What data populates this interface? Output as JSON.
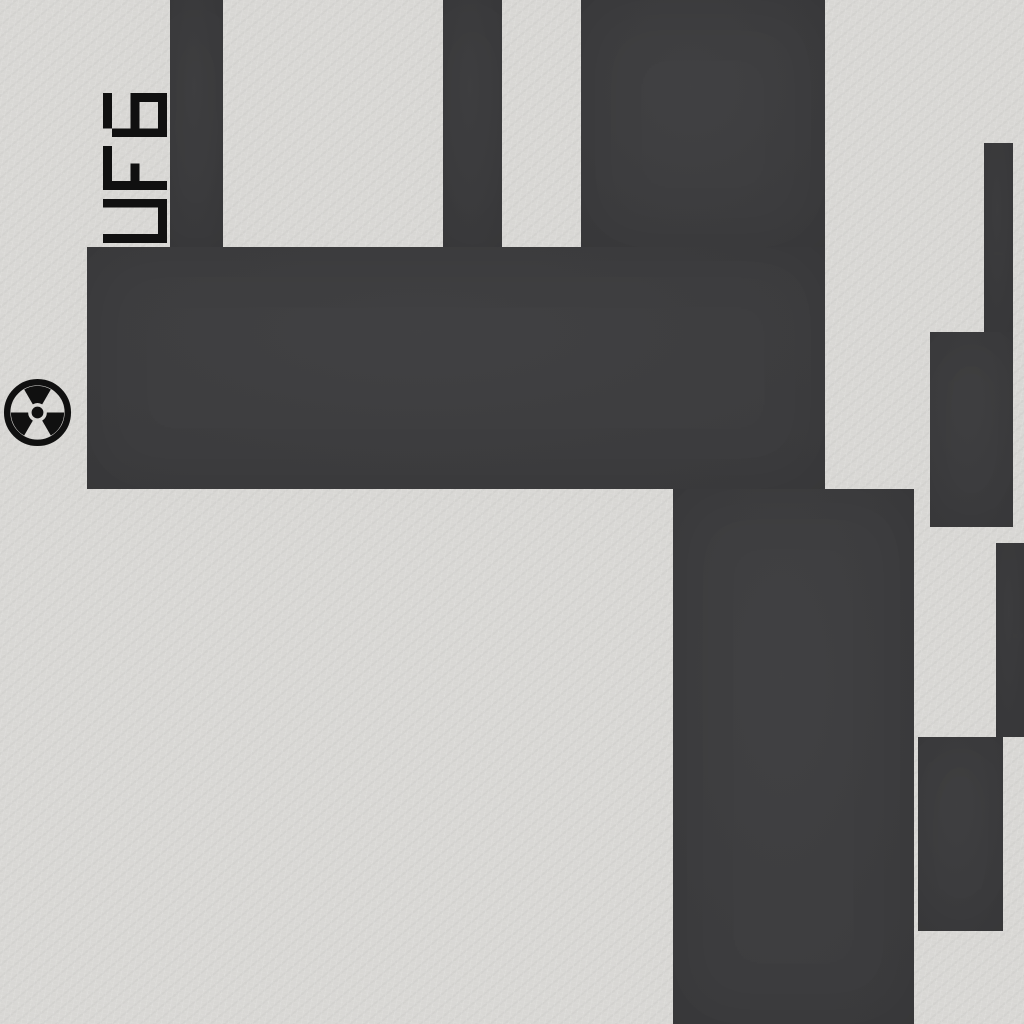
{
  "scene": {
    "label": {
      "text": "UF6"
    },
    "icon": {
      "name": "radiation-trefoil"
    },
    "colors": {
      "background": "#d8d7d4",
      "block": "#3c3c3e",
      "ink": "#101010"
    },
    "map": {
      "width": 1024,
      "height": 1024,
      "blocks": [
        {
          "name": "duct-top-left",
          "x": 170,
          "y": 0,
          "w": 53,
          "h": 248
        },
        {
          "name": "duct-top-middle",
          "x": 443,
          "y": 0,
          "w": 59,
          "h": 248
        },
        {
          "name": "block-top-right",
          "x": 581,
          "y": 0,
          "w": 244,
          "h": 248
        },
        {
          "name": "block-main-horizontal",
          "x": 87,
          "y": 247,
          "w": 738,
          "h": 242
        },
        {
          "name": "duct-lower-vertical",
          "x": 673,
          "y": 489,
          "w": 241,
          "h": 535
        },
        {
          "name": "bar-right-upper",
          "x": 984,
          "y": 143,
          "w": 29,
          "h": 189
        },
        {
          "name": "block-right-upper",
          "x": 930,
          "y": 332,
          "w": 83,
          "h": 195
        },
        {
          "name": "bar-right-edge",
          "x": 996,
          "y": 543,
          "w": 28,
          "h": 194
        },
        {
          "name": "block-right-lower",
          "x": 918,
          "y": 737,
          "w": 85,
          "h": 194
        }
      ]
    }
  }
}
